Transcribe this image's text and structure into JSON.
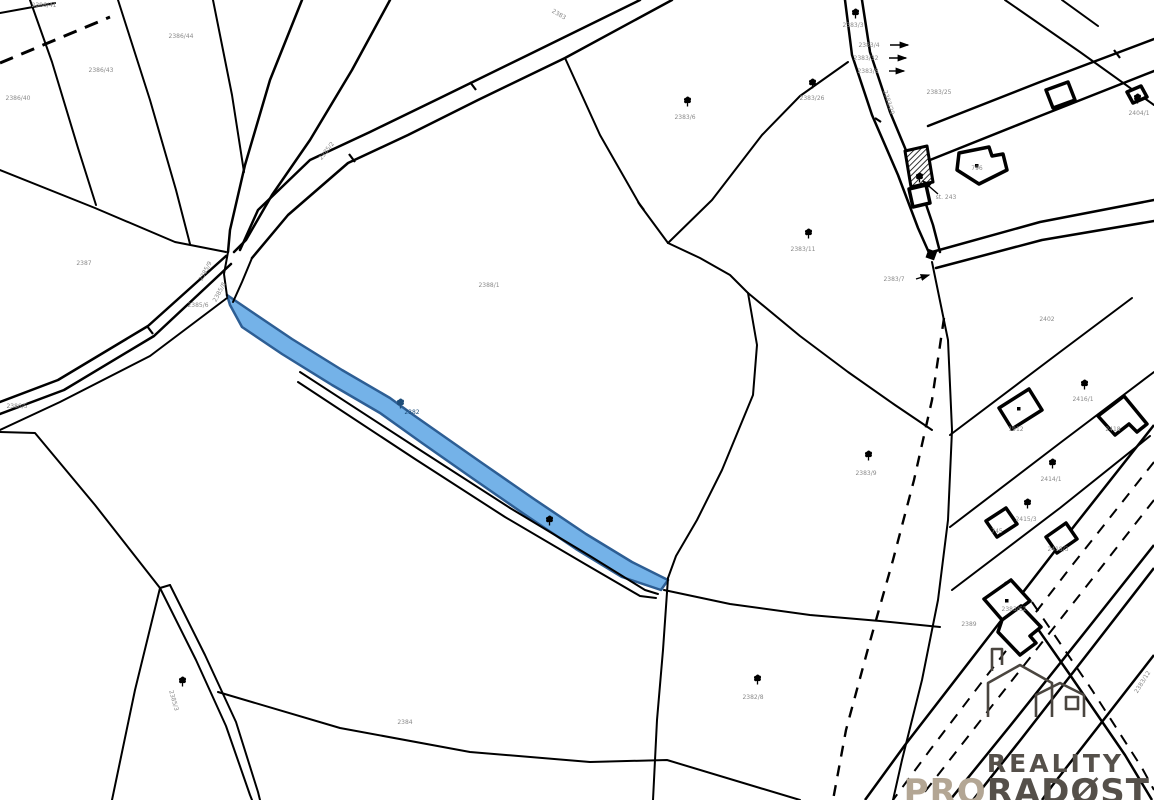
{
  "map": {
    "background": "#ffffff",
    "line_color": "#000000",
    "label_color": "#8a8a8a",
    "highlight": {
      "fill": "#74B2E8",
      "stroke": "#2D5E94",
      "parcel_label": "2382",
      "label_color": "#1f4e79"
    },
    "labels": [
      {
        "text": "2386/40",
        "x": 18,
        "y": 100
      },
      {
        "text": "2386/43",
        "x": 101,
        "y": 72
      },
      {
        "text": "2386/44",
        "x": 181,
        "y": 38
      },
      {
        "text": "2386/41",
        "x": 44,
        "y": 7
      },
      {
        "text": "2387",
        "x": 84,
        "y": 265
      },
      {
        "text": "2386/5",
        "x": 17,
        "y": 408
      },
      {
        "text": "2385/9",
        "x": 207,
        "y": 272,
        "rot": -62
      },
      {
        "text": "2385/8",
        "x": 221,
        "y": 293,
        "rot": -62
      },
      {
        "text": "2385/6",
        "x": 198,
        "y": 307
      },
      {
        "text": "2388/1",
        "x": 489,
        "y": 287
      },
      {
        "text": "2383",
        "x": 558,
        "y": 16,
        "rot": 30
      },
      {
        "text": "2385/2",
        "x": 328,
        "y": 152,
        "rot": -52
      },
      {
        "text": "2383/6",
        "x": 685,
        "y": 119
      },
      {
        "text": "2383/11",
        "x": 803,
        "y": 251
      },
      {
        "text": "2383/26",
        "x": 812,
        "y": 100
      },
      {
        "text": "2383/20",
        "x": 887,
        "y": 103,
        "rot": 72
      },
      {
        "text": "2383/3",
        "x": 853,
        "y": 27
      },
      {
        "text": "2383/4",
        "x": 869,
        "y": 47
      },
      {
        "text": "2383/32",
        "x": 866,
        "y": 60
      },
      {
        "text": "2383/8",
        "x": 868,
        "y": 73
      },
      {
        "text": "2383/7",
        "x": 894,
        "y": 281
      },
      {
        "text": "2383/25",
        "x": 939,
        "y": 94
      },
      {
        "text": "796",
        "x": 977,
        "y": 170
      },
      {
        "text": "st. 243",
        "x": 946,
        "y": 199
      },
      {
        "text": "2404/1",
        "x": 1139,
        "y": 115
      },
      {
        "text": "2402",
        "x": 1047,
        "y": 321
      },
      {
        "text": "1912",
        "x": 1016,
        "y": 431
      },
      {
        "text": "2418",
        "x": 1113,
        "y": 431
      },
      {
        "text": "2416/1",
        "x": 1083,
        "y": 401
      },
      {
        "text": "2414/1",
        "x": 1051,
        "y": 481
      },
      {
        "text": "2415/3",
        "x": 1026,
        "y": 521
      },
      {
        "text": "745",
        "x": 997,
        "y": 533
      },
      {
        "text": "2418/3",
        "x": 1058,
        "y": 551
      },
      {
        "text": "2383/62",
        "x": 1014,
        "y": 611
      },
      {
        "text": "2389",
        "x": 969,
        "y": 626
      },
      {
        "text": "2384",
        "x": 405,
        "y": 724
      },
      {
        "text": "2382/8",
        "x": 753,
        "y": 699
      },
      {
        "text": "2383/9",
        "x": 866,
        "y": 475
      },
      {
        "text": "2383/12",
        "x": 1144,
        "y": 683,
        "rot": -58
      },
      {
        "text": "2385/3",
        "x": 172,
        "y": 701,
        "rot": 74
      },
      {
        "text": "2382",
        "x": 412,
        "y": 414,
        "color": "#1f4e79"
      }
    ],
    "trees": [
      {
        "x": 683,
        "y": 96
      },
      {
        "x": 808,
        "y": 78
      },
      {
        "x": 851,
        "y": 8
      },
      {
        "x": 804,
        "y": 228
      },
      {
        "x": 864,
        "y": 450
      },
      {
        "x": 753,
        "y": 674
      },
      {
        "x": 1133,
        "y": 93
      },
      {
        "x": 1080,
        "y": 379
      },
      {
        "x": 1048,
        "y": 458
      },
      {
        "x": 1023,
        "y": 498
      },
      {
        "x": 545,
        "y": 515
      },
      {
        "x": 178,
        "y": 676
      },
      {
        "x": 915,
        "y": 172
      },
      {
        "x": 396,
        "y": 398,
        "color": "#1f4e79"
      }
    ],
    "arrows": [
      {
        "x1": 890,
        "y1": 45,
        "x2": 908,
        "y2": 45
      },
      {
        "x1": 889,
        "y1": 58,
        "x2": 906,
        "y2": 58
      },
      {
        "x1": 889,
        "y1": 71,
        "x2": 904,
        "y2": 71
      },
      {
        "x1": 916,
        "y1": 279,
        "x2": 929,
        "y2": 275
      },
      {
        "x1": 938,
        "y1": 194,
        "x2": 923,
        "y2": 181
      }
    ],
    "dots": [
      {
        "x": 975,
        "y": 164
      },
      {
        "x": 1017,
        "y": 407
      },
      {
        "x": 1005,
        "y": 599
      }
    ]
  },
  "logo": {
    "line1": "REALITY",
    "line2_accent": "PRO",
    "line2_rest": "RADØST",
    "primary_color": "#55504A",
    "accent_color": "#B3A694"
  }
}
